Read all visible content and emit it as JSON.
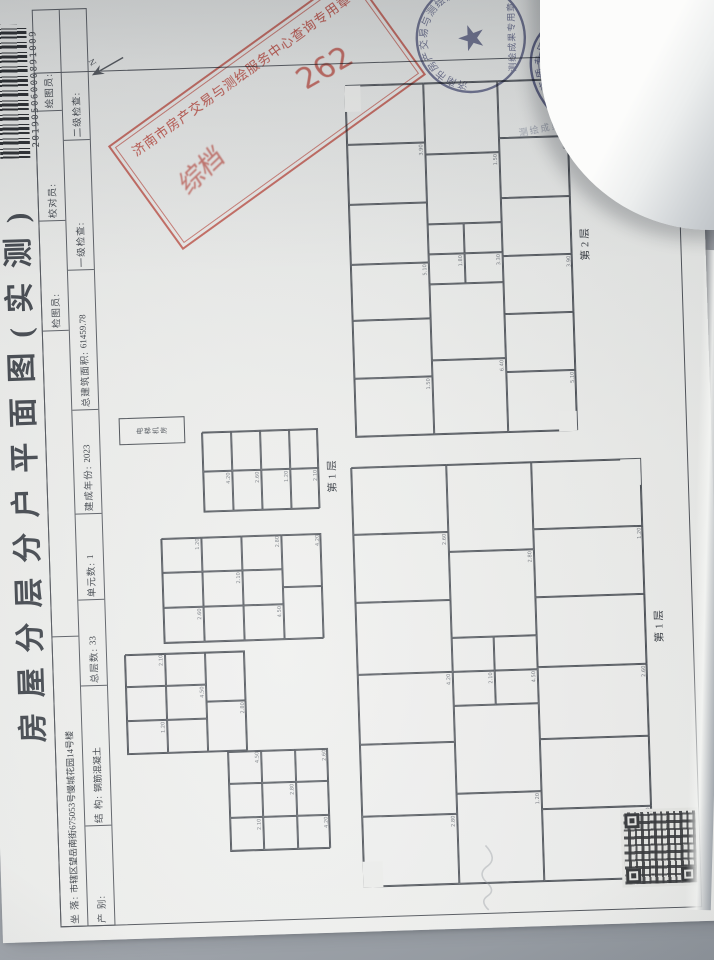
{
  "title": "房屋分层分户平面图(实测)",
  "barcode_number": "20190506000891009",
  "header": {
    "row1": [
      {
        "l": "坐 落:",
        "v": "市辖区望岳南街675053号慢城花园14号楼",
        "w": 290
      },
      {
        "l": "",
        "v": "",
        "w": 306
      },
      {
        "l": "检图员:",
        "v": "",
        "w": 110
      },
      {
        "l": "校对员:",
        "v": "",
        "w": 110
      },
      {
        "l": "绘图员:",
        "v": "",
        "w": 100
      }
    ],
    "row2": [
      {
        "l": "产 别:",
        "v": "",
        "w": 100
      },
      {
        "l": "结 构:",
        "v": "钢筋混凝土",
        "w": 140
      },
      {
        "l": "总层数:",
        "v": "33",
        "w": 86
      },
      {
        "l": "单元数:",
        "v": "1",
        "w": 86
      },
      {
        "l": "建成年份:",
        "v": "2023",
        "w": 104
      },
      {
        "l": "总建筑面积:",
        "v": "61459.78",
        "w": 140
      },
      {
        "l": "一级检查:",
        "v": "",
        "w": 130
      },
      {
        "l": "二级检查:",
        "v": "",
        "w": 130
      }
    ]
  },
  "stamps": {
    "rect": {
      "line": "济南市房产交易与测绘服务中心查询专用章",
      "note": "综档",
      "number": "262"
    },
    "round": {
      "ring": "济南市房产交易与测绘服务中心",
      "bottom": "测绘成果专用章",
      "star": "★"
    },
    "oval": {
      "ring": "测绘资质专用章",
      "grade": "甲 级",
      "org": "济南市房产测绘研究院",
      "no": "37·Y·0025"
    }
  },
  "margin_note": "测绘成果仅供查询使用",
  "north_label": "N",
  "dims": [
    "2.80",
    "3.30",
    "4.20",
    "1.50",
    "2.60",
    "5.10",
    "1.20",
    "3.90",
    "2.10",
    "6.40",
    "4.50",
    "1.80"
  ],
  "plans": [
    {
      "id": "floor1",
      "caption": "第1层",
      "x": 44,
      "y": 362,
      "w": 420,
      "h": 290,
      "cap": {
        "x": 236,
        "y": 296
      },
      "seed": 0,
      "rooms": [
        [
          0,
          0,
          70,
          95
        ],
        [
          70,
          0,
          72,
          95
        ],
        [
          142,
          0,
          70,
          95
        ],
        [
          212,
          0,
          72,
          95
        ],
        [
          284,
          0,
          68,
          95
        ],
        [
          352,
          0,
          68,
          95
        ],
        [
          0,
          95,
          90,
          85
        ],
        [
          90,
          95,
          88,
          85
        ],
        [
          178,
          95,
          34,
          42
        ],
        [
          212,
          95,
          34,
          42
        ],
        [
          178,
          137,
          34,
          43
        ],
        [
          212,
          137,
          34,
          43
        ],
        [
          246,
          95,
          86,
          85
        ],
        [
          332,
          95,
          88,
          85
        ],
        [
          0,
          180,
          72,
          110
        ],
        [
          72,
          180,
          70,
          110
        ],
        [
          142,
          180,
          72,
          110
        ],
        [
          214,
          180,
          70,
          110
        ],
        [
          284,
          180,
          68,
          110
        ],
        [
          352,
          180,
          68,
          110
        ]
      ],
      "cuts": [
        [
          0,
          0,
          26,
          20
        ],
        [
          394,
          270,
          26,
          20
        ]
      ]
    },
    {
      "id": "floor2",
      "caption": "第2层",
      "x": 494,
      "y": 368,
      "w": 352,
      "h": 222,
      "cap": {
        "x": 170,
        "y": 228
      },
      "seed": 3,
      "rooms": [
        [
          0,
          0,
          58,
          78
        ],
        [
          58,
          0,
          58,
          78
        ],
        [
          116,
          0,
          56,
          78
        ],
        [
          172,
          0,
          60,
          78
        ],
        [
          232,
          0,
          60,
          78
        ],
        [
          292,
          0,
          60,
          78
        ],
        [
          0,
          78,
          74,
          74
        ],
        [
          74,
          78,
          76,
          74
        ],
        [
          150,
          78,
          30,
          36
        ],
        [
          180,
          78,
          30,
          36
        ],
        [
          150,
          114,
          30,
          38
        ],
        [
          180,
          114,
          30,
          38
        ],
        [
          210,
          78,
          70,
          74
        ],
        [
          280,
          78,
          72,
          74
        ],
        [
          0,
          152,
          60,
          70
        ],
        [
          60,
          152,
          58,
          70
        ],
        [
          118,
          152,
          58,
          70
        ],
        [
          176,
          152,
          58,
          70
        ],
        [
          234,
          152,
          60,
          70
        ],
        [
          294,
          152,
          58,
          70
        ]
      ],
      "cuts": [
        [
          326,
          0,
          26,
          16
        ],
        [
          0,
          204,
          20,
          18
        ]
      ]
    },
    {
      "id": "shaft",
      "caption": "",
      "x": 494,
      "y": 132,
      "w": 27,
      "h": 66,
      "seed": 5,
      "text": "电梯机房",
      "rooms": []
    },
    {
      "id": "annex-b",
      "caption": "第1层",
      "x": 424,
      "y": 214,
      "w": 80,
      "h": 116,
      "cap": {
        "x": 16,
        "y": 122
      },
      "seed": 2,
      "rooms": [
        [
          0,
          0,
          40,
          29
        ],
        [
          40,
          0,
          40,
          29
        ],
        [
          0,
          29,
          40,
          29
        ],
        [
          40,
          29,
          40,
          29
        ],
        [
          0,
          58,
          40,
          29
        ],
        [
          40,
          58,
          40,
          29
        ],
        [
          0,
          87,
          40,
          29
        ],
        [
          40,
          87,
          40,
          29
        ]
      ],
      "cuts": []
    },
    {
      "id": "annex-c",
      "caption": "",
      "x": 294,
      "y": 170,
      "w": 105,
      "h": 160,
      "seed": 4,
      "rooms": [
        [
          0,
          0,
          35,
          40
        ],
        [
          35,
          0,
          35,
          40
        ],
        [
          70,
          0,
          35,
          40
        ],
        [
          0,
          40,
          35,
          40
        ],
        [
          35,
          40,
          35,
          40
        ],
        [
          70,
          40,
          35,
          40
        ],
        [
          0,
          80,
          35,
          40
        ],
        [
          35,
          80,
          35,
          40
        ],
        [
          70,
          80,
          35,
          40
        ],
        [
          0,
          120,
          52,
          40
        ],
        [
          52,
          120,
          53,
          40
        ]
      ],
      "cuts": []
    },
    {
      "id": "annex-d",
      "caption": "",
      "x": 184,
      "y": 130,
      "w": 100,
      "h": 120,
      "seed": 6,
      "rooms": [
        [
          0,
          0,
          33,
          40
        ],
        [
          33,
          0,
          34,
          40
        ],
        [
          67,
          0,
          33,
          40
        ],
        [
          0,
          40,
          33,
          40
        ],
        [
          33,
          40,
          34,
          40
        ],
        [
          67,
          40,
          33,
          40
        ],
        [
          0,
          80,
          50,
          40
        ],
        [
          50,
          80,
          50,
          40
        ]
      ],
      "cuts": []
    },
    {
      "id": "annex-e",
      "caption": "",
      "x": 84,
      "y": 230,
      "w": 100,
      "h": 100,
      "seed": 8,
      "rooms": [
        [
          0,
          0,
          33,
          33
        ],
        [
          33,
          0,
          34,
          33
        ],
        [
          67,
          0,
          33,
          33
        ],
        [
          0,
          33,
          33,
          34
        ],
        [
          33,
          33,
          34,
          34
        ],
        [
          67,
          33,
          33,
          34
        ],
        [
          0,
          67,
          33,
          33
        ],
        [
          33,
          67,
          34,
          33
        ],
        [
          67,
          67,
          33,
          33
        ]
      ],
      "cuts": []
    }
  ]
}
